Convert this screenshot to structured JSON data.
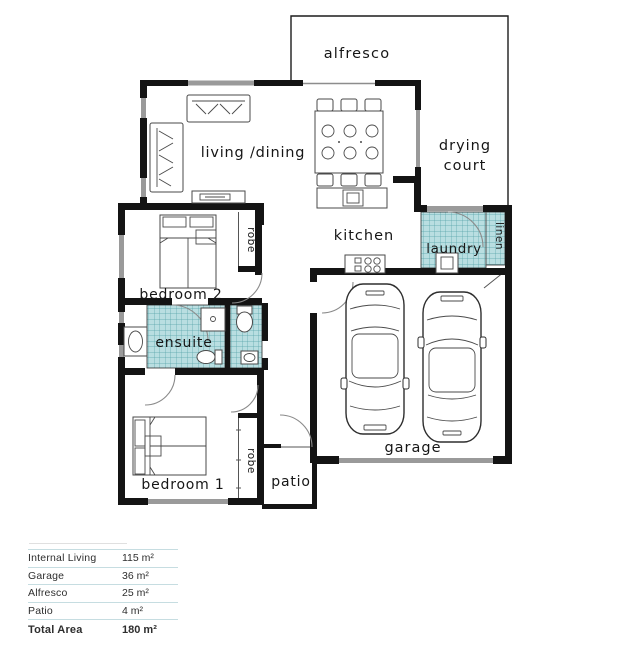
{
  "plan": {
    "labels": {
      "alfresco": "alfresco",
      "living_dining": "living /dining",
      "drying_line1": "drying",
      "drying_line2": "court",
      "kitchen": "kitchen",
      "laundry": "laundry",
      "linen": "linen",
      "robe_bed2": "robe",
      "bedroom2": "bedroom 2",
      "ensuite": "ensuite",
      "bedroom1": "bedroom 1",
      "robe_bed1": "robe",
      "patio": "patio",
      "garage": "garage"
    }
  },
  "areas_table": {
    "rows": [
      {
        "label": "Internal Living",
        "value": "115 m²"
      },
      {
        "label": "Garage",
        "value": "36 m²"
      },
      {
        "label": "Alfresco",
        "value": "25 m²"
      },
      {
        "label": "Patio",
        "value": "4 m²"
      }
    ],
    "total": {
      "label": "Total Area",
      "value": "180 m²"
    }
  },
  "colors": {
    "wall": "#141414",
    "window": "#9a9a9a",
    "tile_fill": "#b9dee1",
    "tile_line": "#56a2a8",
    "table_divider": "#c6dde1",
    "text": "#161616"
  }
}
